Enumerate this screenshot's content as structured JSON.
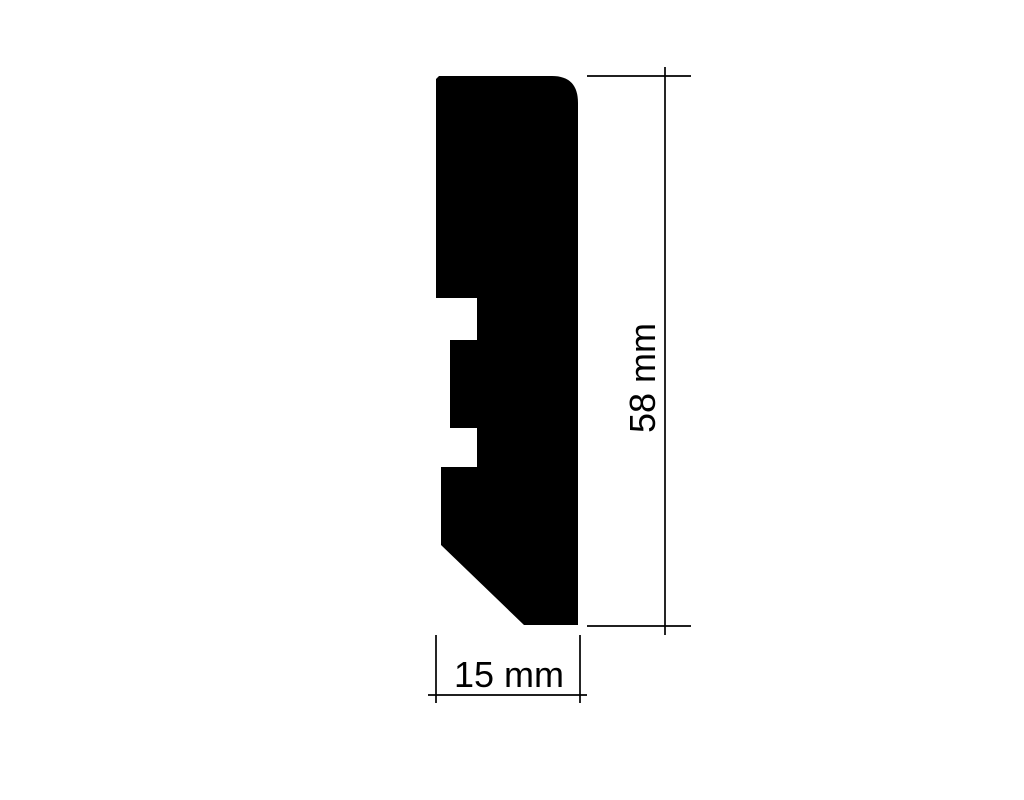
{
  "canvas": {
    "background": "#ffffff"
  },
  "profile": {
    "fill": "#000000"
  },
  "line_color": "#000000",
  "dimensions": {
    "height": {
      "label": "58 mm",
      "value": 58,
      "unit": "mm"
    },
    "width": {
      "label": "15 mm",
      "value": 15,
      "unit": "mm"
    }
  }
}
